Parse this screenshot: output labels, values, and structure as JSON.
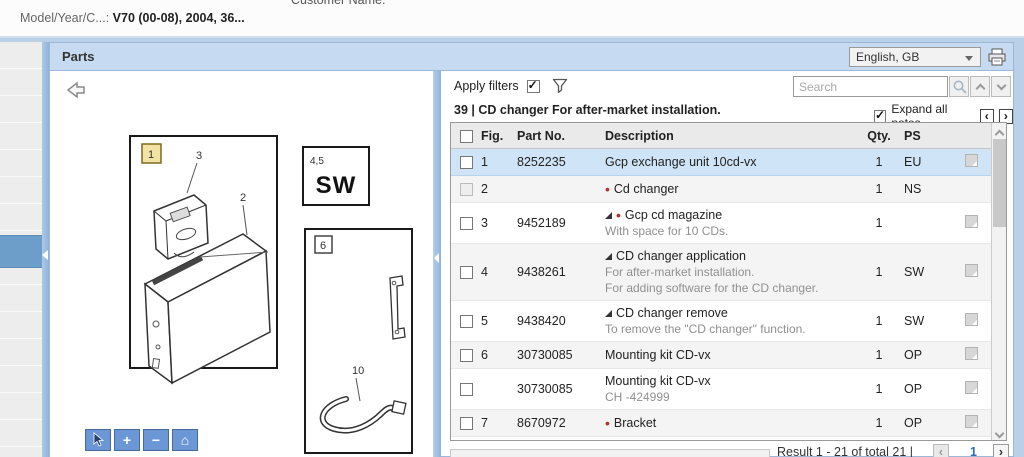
{
  "header": {
    "model_label": "Model/Year/C...:",
    "model_value": "V70 (00-08), 2004, 36...",
    "customer_label": "Customer Name:"
  },
  "parts_bar": {
    "title": "Parts",
    "language": "English, GB"
  },
  "filter_bar": {
    "apply_filters": "Apply filters",
    "search_placeholder": "Search",
    "section_title": "39  |  CD changer For after-market installation.",
    "expand_all_notes": "Expand all notes"
  },
  "diagram": {
    "labels": {
      "fig1": "1",
      "fig2": "2",
      "fig3": "3",
      "fig45": "4,5",
      "sw": "SW",
      "fig6": "6",
      "fig10": "10"
    },
    "tools": {
      "plus": "+",
      "minus": "−",
      "home": "⌂"
    }
  },
  "table": {
    "columns": [
      "Fig.",
      "Part No.",
      "Description",
      "Qty.",
      "PS"
    ],
    "rows": [
      {
        "fig": "1",
        "part": "8252235",
        "desc": "Gcp exchange unit 10cd-vx",
        "notes": [],
        "qty": "1",
        "ps": "EU",
        "icon": true,
        "selected": true
      },
      {
        "fig": "2",
        "part": "",
        "desc": "Cd changer",
        "bullet": true,
        "notes": [],
        "qty": "1",
        "ps": "NS",
        "icon": false,
        "disabled": true
      },
      {
        "fig": "3",
        "part": "9452189",
        "desc": "Gcp cd magazine",
        "tri": true,
        "bullet": true,
        "notes": [
          "With space for 10 CDs."
        ],
        "qty": "1",
        "ps": "",
        "icon": true
      },
      {
        "fig": "4",
        "part": "9438261",
        "desc": "CD changer application",
        "tri": true,
        "notes": [
          "For after-market installation.",
          "For adding software for the CD changer."
        ],
        "qty": "1",
        "ps": "SW",
        "icon": true
      },
      {
        "fig": "5",
        "part": "9438420",
        "desc": "CD changer remove",
        "tri": true,
        "notes": [
          "To remove the \"CD changer\" function."
        ],
        "qty": "1",
        "ps": "SW",
        "icon": true
      },
      {
        "fig": "6",
        "part": "30730085",
        "desc": "Mounting kit CD-vx",
        "notes": [],
        "qty": "1",
        "ps": "OP",
        "icon": true
      },
      {
        "fig": "",
        "part": "30730085",
        "desc": "Mounting kit CD-vx",
        "notes": [
          "CH -424999"
        ],
        "qty": "1",
        "ps": "OP",
        "icon": true
      },
      {
        "fig": "7",
        "part": "8670972",
        "desc": "Bracket",
        "bullet": true,
        "notes": [],
        "qty": "1",
        "ps": "OP",
        "icon": true
      }
    ]
  },
  "pagination": {
    "result_text": "Result 1 - 21 of total 21  |",
    "page": "1"
  },
  "icons": {
    "prev": "‹",
    "next": "›",
    "bullet": "•",
    "check": "✓"
  }
}
